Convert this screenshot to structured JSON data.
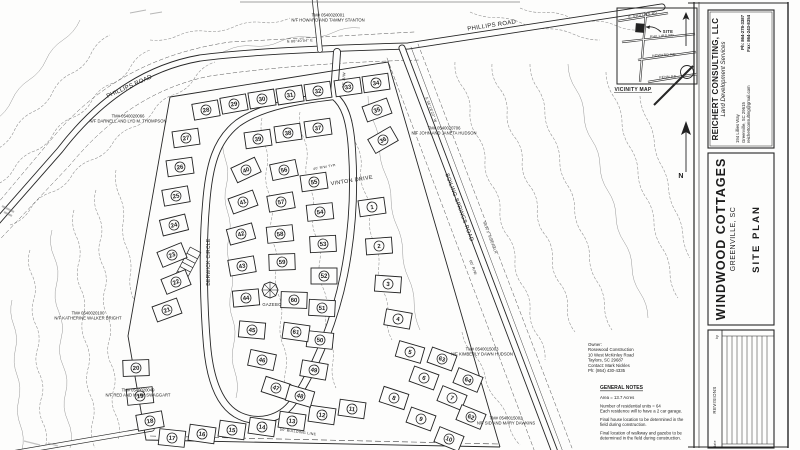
{
  "title_block": {
    "firm_name": "REICHERT CONSULTING, LLC",
    "firm_tagline": "Land Development Services",
    "address": [
      "194 Lillies Way",
      "Greenville, SC 29615",
      "reichertconsulting@gmail.com"
    ],
    "contact": [
      "Ph: 864-278-3387",
      "Fax: 864-243-8354"
    ],
    "project_name": "WINDWOOD COTTAGES",
    "project_location": "GREENVILLE, SC",
    "sheet_title": "SITE PLAN"
  },
  "owner_block": [
    "Owner:",
    "Rosewood Construction",
    "10 West McKinley Road",
    "Taylors, SC 29687",
    "Contact: Mark Nickles",
    "Ph: (864) 430-4335"
  ],
  "general_notes": {
    "heading": "GENERAL NOTES",
    "paragraphs": [
      [
        "Area = 13.7 Acres"
      ],
      [
        "Number of residential units = 64",
        "Each residence will to have a 2 car garage."
      ],
      [
        "Final house location to be determined in the",
        "field during construction."
      ],
      [
        "Final location of walkway and gazebo to be",
        "determined in the field during construction."
      ]
    ]
  },
  "labels": [
    {
      "t": "PHILLIPS ROAD",
      "x": 130,
      "y": 88,
      "s": 6,
      "r": -24,
      "n": "street-label-phillips-road-west"
    },
    {
      "t": "PHILLIPS ROAD",
      "x": 492,
      "y": 27,
      "s": 6,
      "r": -8.5,
      "n": "street-label-phillips-road-east"
    },
    {
      "t": "BOILING SPRINGS ROAD",
      "x": 458,
      "y": 208,
      "s": 5.5,
      "r": 69.5,
      "n": "street-label-boiling-springs-road"
    },
    {
      "t": "VINTON DRIVE",
      "x": 352,
      "y": 182,
      "s": 5.5,
      "r": -9,
      "n": "street-label-vinton-drive"
    },
    {
      "t": "BERWICK CIRCLE",
      "x": 210,
      "y": 262,
      "s": 5,
      "r": -90,
      "n": "street-label-berwick-circle"
    },
    {
      "t": "50' R/W",
      "x": 345,
      "y": 80,
      "s": 3.8,
      "r": -87,
      "n": "right-of-way-note"
    },
    {
      "t": "40' R/W TYP.",
      "x": 325,
      "y": 168,
      "s": 3.4,
      "r": -10,
      "n": "right-of-way-note"
    },
    {
      "t": "60' R/W",
      "x": 472,
      "y": 268,
      "s": 3.8,
      "r": 69.5,
      "n": "right-of-way-note"
    },
    {
      "t": "NEW 5' SIDEWALK",
      "x": 489,
      "y": 238,
      "s": 3.4,
      "r": 69.5,
      "n": "sidewalk-note"
    },
    {
      "t": "N 88°40'04\" E",
      "x": 300,
      "y": 42,
      "s": 3.6,
      "r": -3,
      "n": "bearing-label"
    },
    {
      "t": "S 36°18'22\" W",
      "x": 430,
      "y": 110,
      "s": 3.6,
      "r": 69.5,
      "n": "bearing-label"
    },
    {
      "t": "50' BUILDING LINE",
      "x": 298,
      "y": 433,
      "s": 3.6,
      "r": 8,
      "n": "building-line-note"
    },
    {
      "t": "GAZEBO",
      "x": 272,
      "y": 306,
      "s": 4.2,
      "r": 0,
      "n": "gazebo-label"
    },
    {
      "t": "SITE",
      "x": 668,
      "y": 33,
      "s": 4.2,
      "r": 0,
      "b": 1,
      "n": "vicinity-site-label"
    },
    {
      "t": "VICINITY MAP",
      "x": 633,
      "y": 91,
      "s": 5,
      "r": 0,
      "b": 1,
      "n": "vicinity-map-label"
    },
    {
      "t": "E. PHILLIPS RD",
      "x": 643,
      "y": 16,
      "s": 3.4,
      "r": -9,
      "n": "vicinity-road-label"
    },
    {
      "t": "PHILLIPS RD",
      "x": 662,
      "y": 37,
      "s": 3.4,
      "r": -4,
      "n": "vicinity-road-label"
    },
    {
      "t": "HOWARD RD",
      "x": 664,
      "y": 56,
      "s": 3.4,
      "r": -4,
      "n": "vicinity-road-label"
    },
    {
      "t": "PENN RD",
      "x": 668,
      "y": 78,
      "s": 3.4,
      "r": -4,
      "n": "vicinity-road-label"
    },
    {
      "t": "N",
      "x": 681,
      "y": 178,
      "s": 7,
      "r": 0,
      "b": 1,
      "n": "north-arrow-label"
    },
    {
      "t": "REVISIONS",
      "x": 716,
      "y": 400,
      "s": 4.5,
      "r": -90,
      "n": "revisions-label"
    },
    {
      "t": "by",
      "x": 718,
      "y": 337,
      "s": 3.2,
      "r": -90,
      "n": "revisions-by-header"
    },
    {
      "t": "date",
      "x": 716,
      "y": 444,
      "s": 3.2,
      "r": -90,
      "n": "revisions-date-header"
    }
  ],
  "parcels": [
    {
      "l1": "TM# 0540020001",
      "l2": "N/F HOWARD AND TAMMY STANTON",
      "x": 328,
      "y": 18
    },
    {
      "l1": "TM# 0540020066",
      "l2": "N/F DARNELL AND LYD M. THOMPSON",
      "x": 128,
      "y": 119
    },
    {
      "l1": "TM# 0540020706",
      "l2": "N/F JOHN AND JANETA HUDSON",
      "x": 444,
      "y": 131
    },
    {
      "l1": "TM# 0540020100",
      "l2": "N/F KATHERINE WALKER BRIGHT",
      "x": 88,
      "y": 316
    },
    {
      "l1": "TM# 0540020049",
      "l2": "N/F RED AND MARY SWAGGART",
      "x": 138,
      "y": 393
    },
    {
      "l1": "TM# 0540015003",
      "l2": "N/F KIMBERLY DAWN HUDSON",
      "x": 482,
      "y": 352
    },
    {
      "l1": "TM# 0540015002",
      "l2": "N/F SID AND MARY DAWKINS",
      "x": 506,
      "y": 421
    }
  ],
  "lots": [
    [
      1,
      372,
      207,
      -8
    ],
    [
      2,
      379,
      246,
      -4
    ],
    [
      3,
      388,
      284,
      4
    ],
    [
      4,
      398,
      319,
      10
    ],
    [
      5,
      410,
      352,
      16
    ],
    [
      6,
      424,
      378,
      20
    ],
    [
      7,
      452,
      398,
      22
    ],
    [
      8,
      394,
      398,
      18
    ],
    [
      9,
      421,
      419,
      20
    ],
    [
      10,
      449,
      439,
      22
    ],
    [
      11,
      352,
      409,
      8
    ],
    [
      12,
      322,
      415,
      8
    ],
    [
      13,
      292,
      421,
      8
    ],
    [
      14,
      262,
      427,
      8
    ],
    [
      15,
      232,
      430,
      8
    ],
    [
      16,
      202,
      434,
      8
    ],
    [
      17,
      172,
      438,
      6
    ],
    [
      18,
      150,
      421,
      -10
    ],
    [
      19,
      140,
      396,
      -6
    ],
    [
      20,
      136,
      368,
      -2
    ],
    [
      21,
      167,
      310,
      -20
    ],
    [
      22,
      176,
      282,
      -22
    ],
    [
      23,
      172,
      255,
      -22
    ],
    [
      24,
      174,
      225,
      -14
    ],
    [
      25,
      176,
      196,
      -10
    ],
    [
      26,
      180,
      167,
      -8
    ],
    [
      27,
      186,
      138,
      -8
    ],
    [
      28,
      206,
      110,
      -10
    ],
    [
      29,
      234,
      104,
      -10
    ],
    [
      30,
      262,
      99,
      -9
    ],
    [
      31,
      290,
      95,
      -9
    ],
    [
      32,
      318,
      91,
      -8
    ],
    [
      33,
      348,
      87,
      -8
    ],
    [
      34,
      376,
      83,
      -8
    ],
    [
      35,
      377,
      110,
      -20
    ],
    [
      36,
      383,
      140,
      -30
    ],
    [
      37,
      318,
      128,
      -8
    ],
    [
      38,
      288,
      133,
      -8
    ],
    [
      39,
      258,
      139,
      -8
    ],
    [
      40,
      246,
      170,
      -25
    ],
    [
      41,
      243,
      202,
      -20
    ],
    [
      42,
      241,
      234,
      -15
    ],
    [
      43,
      242,
      266,
      -10
    ],
    [
      44,
      246,
      298,
      -5
    ],
    [
      45,
      252,
      330,
      5
    ],
    [
      46,
      262,
      360,
      12
    ],
    [
      47,
      276,
      388,
      18
    ],
    [
      48,
      300,
      396,
      16
    ],
    [
      49,
      314,
      370,
      10
    ],
    [
      50,
      320,
      340,
      6
    ],
    [
      51,
      322,
      308,
      3
    ],
    [
      52,
      324,
      276,
      0
    ],
    [
      53,
      323,
      244,
      -3
    ],
    [
      54,
      320,
      212,
      -6
    ],
    [
      55,
      314,
      182,
      -8
    ],
    [
      56,
      284,
      170,
      -12
    ],
    [
      57,
      281,
      202,
      -10
    ],
    [
      58,
      280,
      234,
      -6
    ],
    [
      59,
      282,
      262,
      -2
    ],
    [
      60,
      294,
      300,
      2
    ],
    [
      61,
      296,
      332,
      8
    ],
    [
      62,
      471,
      417,
      22
    ],
    [
      63,
      442,
      359,
      20
    ],
    [
      64,
      468,
      380,
      22
    ]
  ]
}
